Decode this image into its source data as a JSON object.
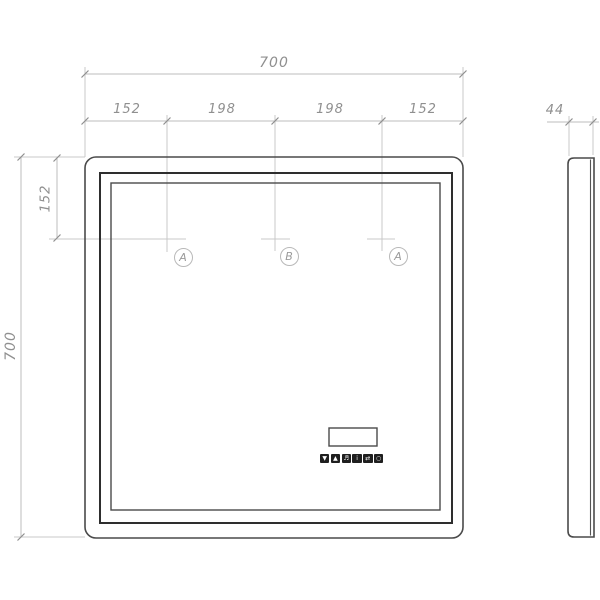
{
  "drawing": {
    "front_view": {
      "dim_width_total": "700",
      "dim_height_total": "700",
      "dim_top_segments": [
        "152",
        "198",
        "198",
        "152"
      ],
      "dim_top_offset": "152",
      "markers": [
        "A",
        "B",
        "A"
      ]
    },
    "side_view": {
      "dim_depth": "44"
    },
    "controls": {
      "buttons": [
        {
          "icon": "arrow-down-icon",
          "glyph": "▼"
        },
        {
          "icon": "arrow-up-icon",
          "glyph": "▲"
        },
        {
          "icon": "music-note-icon",
          "glyph": "♬"
        },
        {
          "icon": "info-icon",
          "glyph": "i"
        },
        {
          "icon": "arrows-swap-icon",
          "glyph": "⇄"
        },
        {
          "icon": "clock-icon",
          "glyph": "○"
        }
      ]
    }
  },
  "colors": {
    "background": "#ffffff",
    "frame-line": "#4a4a4a",
    "frame-line-heavy": "#2e2e2e",
    "dim-line": "#bdbdbd",
    "ext-line": "#c9c9c9",
    "tick": "#8f8f8f",
    "dim-text": "#8f8f8f",
    "button-fill": "#1f1f1f"
  }
}
